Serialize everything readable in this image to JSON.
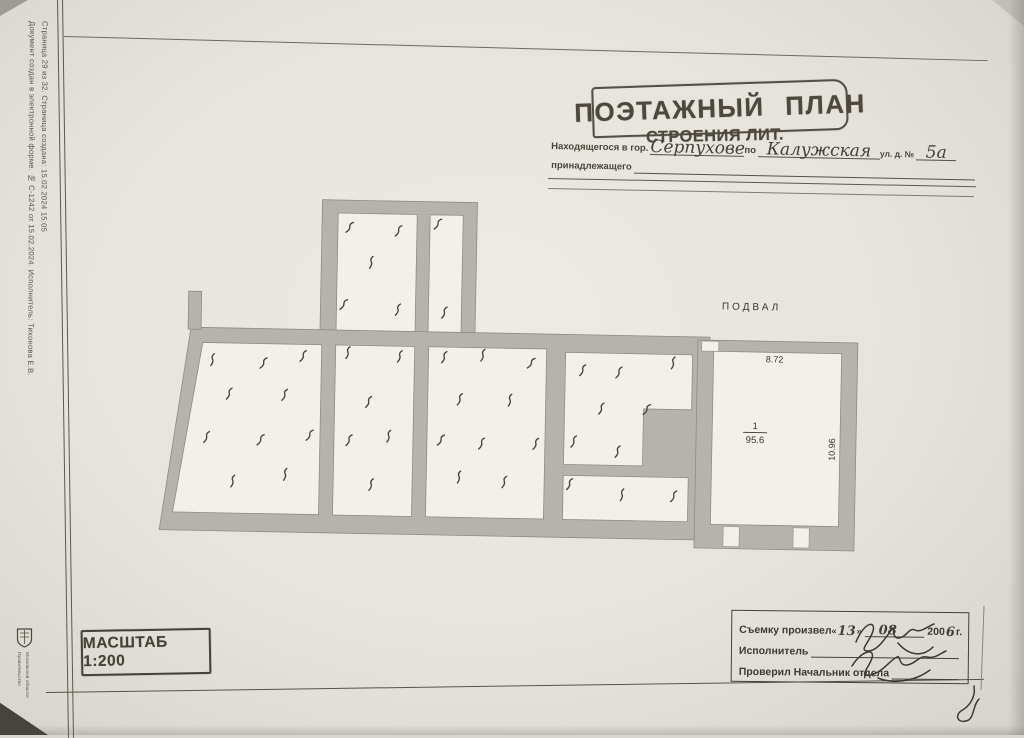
{
  "sidebar": {
    "line1": "Документ создан в электронной форме. № С-1242 от 15.02.2024. Исполнитель: Тихонова Е.В.",
    "line2": "Страница 29 из 32. Страница создана: 15.02.2024 15:05",
    "emblem_caption_line1": "Правительство",
    "emblem_caption_line2": "Московской области"
  },
  "header": {
    "title": "ПОЭТАЖНЫЙ ПЛАН",
    "subtitle": "СТРОЕНИЯ ЛИТ.",
    "located_label": "Находящегося в гор.",
    "city_value": "Серпухове",
    "po_label": "по",
    "street_value": "Калужская",
    "street_suffix_label": "ул. д. №",
    "house_value": "5а",
    "belongs_label": "принадлежащего"
  },
  "plan": {
    "floor_label": "ПОДВАЛ",
    "room_number": "1",
    "room_area": "95.6",
    "width_dim": "8.72",
    "height_dim": "10.96"
  },
  "scale_stamp": {
    "text": "МАСШТАБ 1:200"
  },
  "survey_box": {
    "line1_label": "Съемку произвел",
    "quote_open": "«",
    "day_value": "13",
    "quote_close": "»",
    "month_value": "08",
    "year_prefix": "200",
    "year_value": "6",
    "year_suffix": "г.",
    "line2_label": "Исполнитель",
    "line3_label": "Проверил Начальник отдела"
  }
}
